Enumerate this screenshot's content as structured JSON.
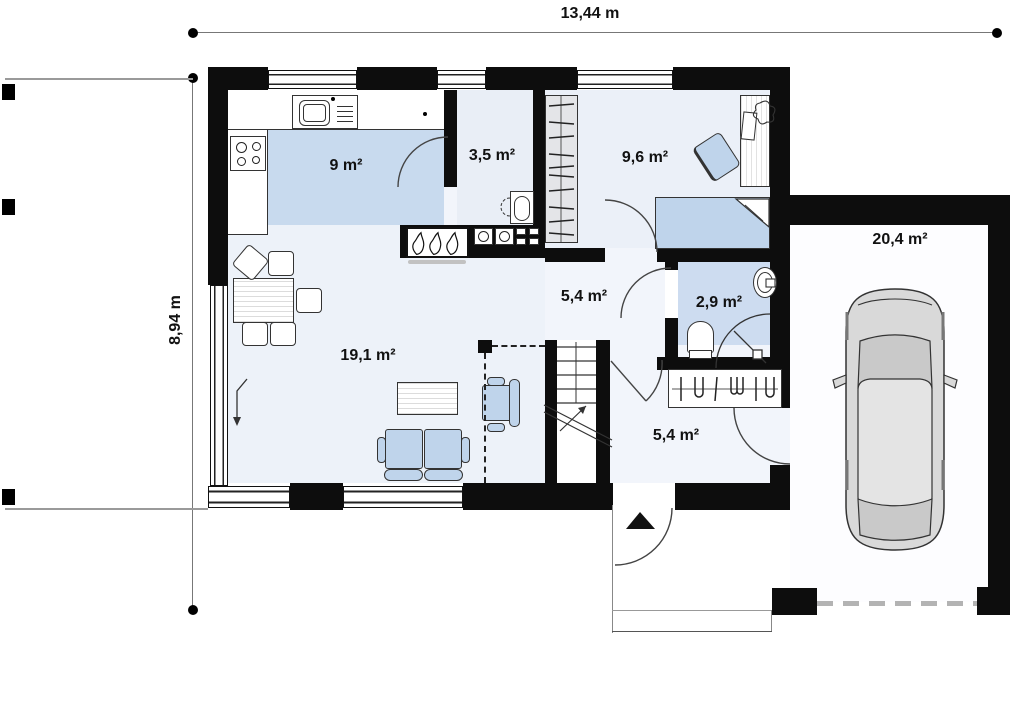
{
  "title": "House floor plan",
  "dimensions": {
    "width": "13,44 m",
    "height": "8,94 m"
  },
  "rooms": [
    {
      "name": "kitchen",
      "area": "9 m²"
    },
    {
      "name": "utility",
      "area": "3,5 m²"
    },
    {
      "name": "bedroom",
      "area": "9,6 m²"
    },
    {
      "name": "hall",
      "area": "5,4 m²"
    },
    {
      "name": "bathroom",
      "area": "2,9 m²"
    },
    {
      "name": "living-room",
      "area": "19,1 m²"
    },
    {
      "name": "entry",
      "area": "5,4 m²"
    },
    {
      "name": "garage",
      "area": "20,4 m²"
    }
  ],
  "colors": {
    "wall": "#0d0d0d",
    "floor_light": "#edf2f9",
    "floor_blue": "#c8daee",
    "furniture_blue": "#bfd4eb",
    "car_gray": "#d9d9d9",
    "dimension_line": "#888888"
  }
}
